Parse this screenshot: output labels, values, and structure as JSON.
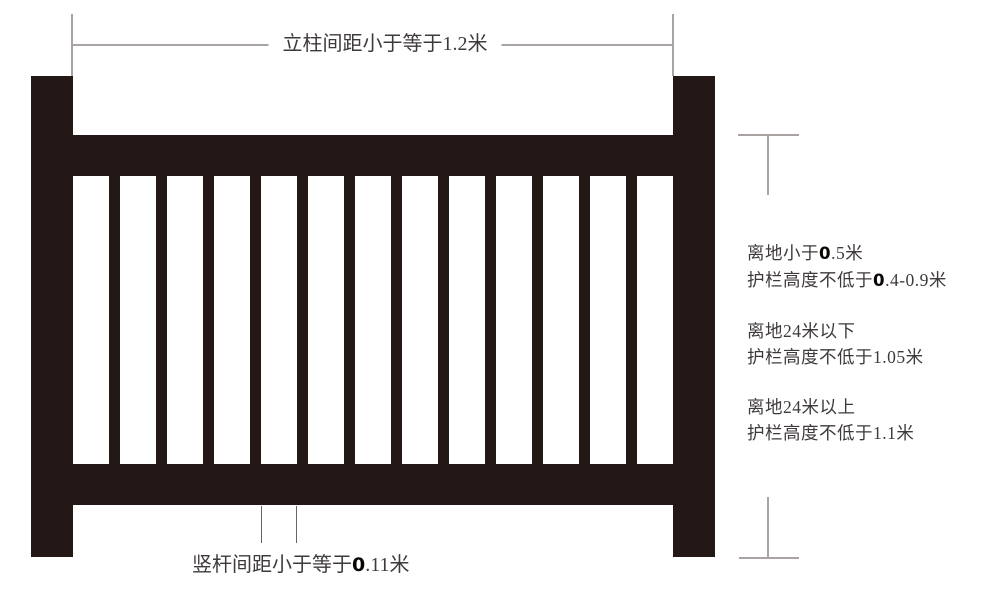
{
  "colors": {
    "railing": "#231815",
    "text": "#3e3a39",
    "bold_number": "#0a0503",
    "dimension_line": "#a9a4a2",
    "leader_line": "#6b6562",
    "background": "#ffffff"
  },
  "diagram": {
    "railing": {
      "post_count": 2,
      "rail_count": 2,
      "vertical_bar_count": 12
    },
    "top_dimension": {
      "label": [
        {
          "t": "立柱间距小于等于1.2米"
        }
      ]
    },
    "bar_spacing_dimension": {
      "label": [
        {
          "t": "竖杆间距小于等于"
        },
        {
          "t": "0",
          "b": true
        },
        {
          "t": ".11米"
        }
      ]
    },
    "height_notes": [
      {
        "line1": [
          {
            "t": "离地小于"
          },
          {
            "t": "0",
            "b": true
          },
          {
            "t": ".5米"
          }
        ],
        "line2": [
          {
            "t": "护栏高度不低于"
          },
          {
            "t": "0",
            "b": true
          },
          {
            "t": ".4-0.9米"
          }
        ]
      },
      {
        "line1": [
          {
            "t": "离地24米以下"
          }
        ],
        "line2": [
          {
            "t": "护栏高度不低于1.05米"
          }
        ]
      },
      {
        "line1": [
          {
            "t": "离地24米以上"
          }
        ],
        "line2": [
          {
            "t": "护栏高度不低于1.1米"
          }
        ]
      }
    ]
  }
}
